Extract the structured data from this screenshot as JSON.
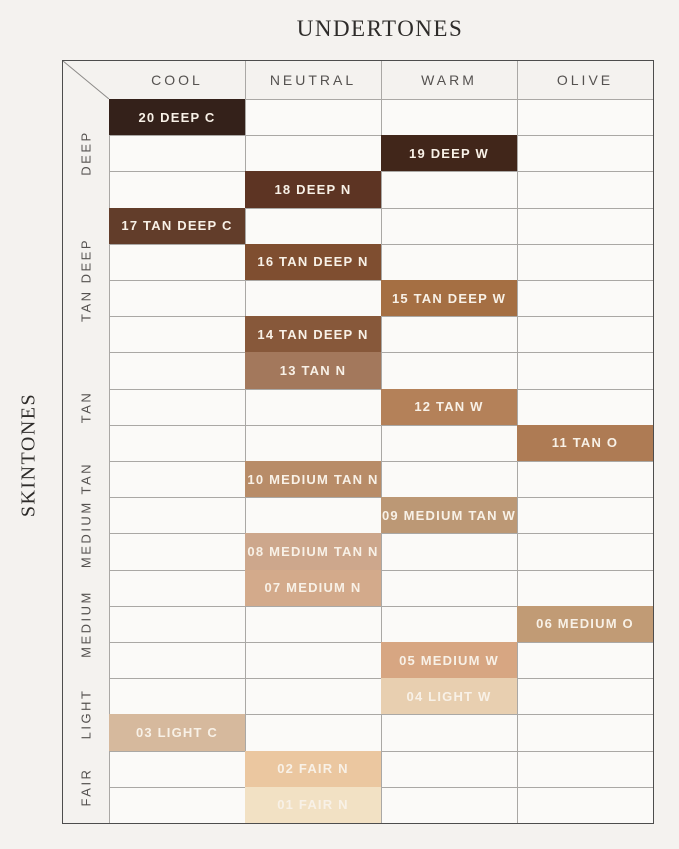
{
  "page": {
    "title": "UNDERTONES",
    "side_title": "SKINTONES"
  },
  "colors": {
    "page_bg": "#f4f2ef",
    "cell_bg": "#fbfaf8",
    "frame_border": "#4d4d4d",
    "grid_line": "#aaa8a5",
    "header_text": "#555250",
    "title_text": "#2e2c2a",
    "shade_text": "#f8f1e7"
  },
  "chart_data": {
    "type": "heatmap",
    "title": "UNDERTONES",
    "xlabel": "UNDERTONES",
    "ylabel": "SKINTONES",
    "x_categories": [
      "COOL",
      "NEUTRAL",
      "WARM",
      "OLIVE"
    ],
    "y_groups": [
      {
        "label": "DEEP",
        "row_count": 3
      },
      {
        "label": "TAN DEEP",
        "row_count": 4
      },
      {
        "label": "TAN",
        "row_count": 3
      },
      {
        "label": "MEDIUM TAN",
        "row_count": 3
      },
      {
        "label": "MEDIUM",
        "row_count": 3
      },
      {
        "label": "LIGHT",
        "row_count": 2
      },
      {
        "label": "FAIR",
        "row_count": 2
      }
    ],
    "row_count": 20,
    "cells": [
      {
        "row": 0,
        "undertone": "COOL",
        "skintone": "DEEP",
        "label": "20 DEEP C",
        "color": "#34211a"
      },
      {
        "row": 1,
        "undertone": "WARM",
        "skintone": "DEEP",
        "label": "19 DEEP W",
        "color": "#41261a"
      },
      {
        "row": 2,
        "undertone": "NEUTRAL",
        "skintone": "DEEP",
        "label": "18 DEEP N",
        "color": "#5d3423"
      },
      {
        "row": 3,
        "undertone": "COOL",
        "skintone": "TAN DEEP",
        "label": "17 TAN DEEP C",
        "color": "#623d2a"
      },
      {
        "row": 4,
        "undertone": "NEUTRAL",
        "skintone": "TAN DEEP",
        "label": "16 TAN DEEP N",
        "color": "#7f4e30"
      },
      {
        "row": 5,
        "undertone": "WARM",
        "skintone": "TAN DEEP",
        "label": "15 TAN DEEP W",
        "color": "#a56f43"
      },
      {
        "row": 6,
        "undertone": "NEUTRAL",
        "skintone": "TAN DEEP",
        "label": "14 TAN DEEP N",
        "color": "#87583a"
      },
      {
        "row": 7,
        "undertone": "NEUTRAL",
        "skintone": "TAN",
        "label": "13 TAN N",
        "color": "#a3785c"
      },
      {
        "row": 8,
        "undertone": "WARM",
        "skintone": "TAN",
        "label": "12 TAN W",
        "color": "#b48159"
      },
      {
        "row": 9,
        "undertone": "OLIVE",
        "skintone": "TAN",
        "label": "11 TAN O",
        "color": "#ae7b54"
      },
      {
        "row": 10,
        "undertone": "NEUTRAL",
        "skintone": "MEDIUM TAN",
        "label": "10 MEDIUM TAN N",
        "color": "#b88c68"
      },
      {
        "row": 11,
        "undertone": "WARM",
        "skintone": "MEDIUM TAN",
        "label": "09 MEDIUM TAN W",
        "color": "#bc9875"
      },
      {
        "row": 12,
        "undertone": "NEUTRAL",
        "skintone": "MEDIUM TAN",
        "label": "08 MEDIUM TAN N",
        "color": "#cda78c"
      },
      {
        "row": 13,
        "undertone": "NEUTRAL",
        "skintone": "MEDIUM",
        "label": "07 MEDIUM N",
        "color": "#d3aa8b"
      },
      {
        "row": 14,
        "undertone": "OLIVE",
        "skintone": "MEDIUM",
        "label": "06 MEDIUM O",
        "color": "#c19b75"
      },
      {
        "row": 15,
        "undertone": "WARM",
        "skintone": "MEDIUM",
        "label": "05 MEDIUM W",
        "color": "#d7a682"
      },
      {
        "row": 16,
        "undertone": "WARM",
        "skintone": "LIGHT",
        "label": "04 LIGHT W",
        "color": "#e8cfb0"
      },
      {
        "row": 17,
        "undertone": "COOL",
        "skintone": "LIGHT",
        "label": "03 LIGHT C",
        "color": "#d6b99d"
      },
      {
        "row": 18,
        "undertone": "NEUTRAL",
        "skintone": "FAIR",
        "label": "02 FAIR N",
        "color": "#ebc7a0"
      },
      {
        "row": 19,
        "undertone": "NEUTRAL",
        "skintone": "FAIR",
        "label": "01 FAIR N",
        "color": "#f2e1c4"
      }
    ]
  }
}
